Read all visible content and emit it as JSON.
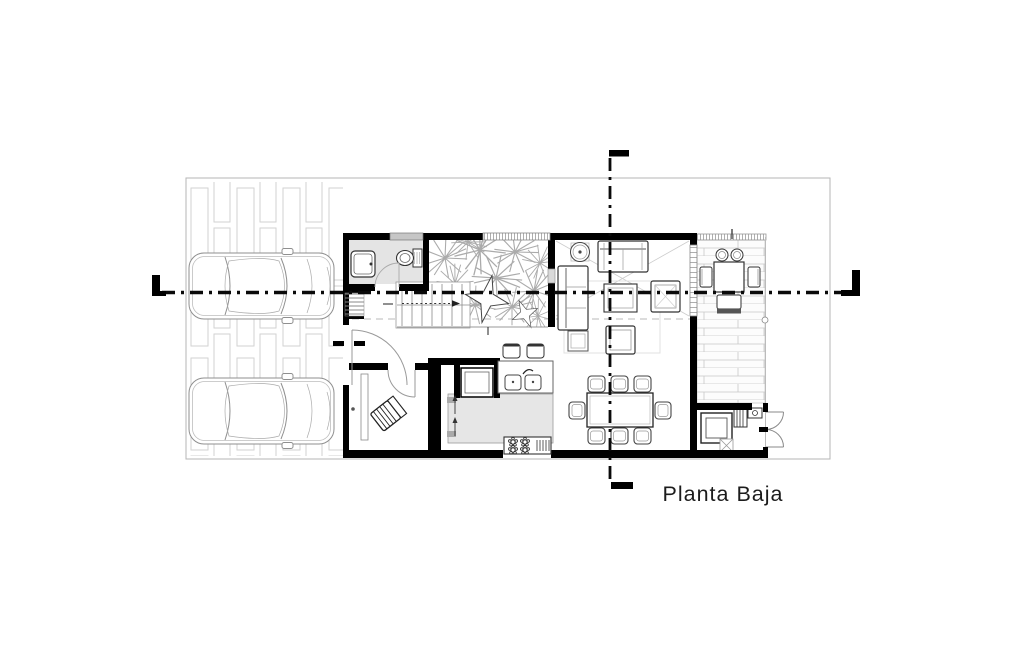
{
  "title": {
    "label": "Planta Baja"
  },
  "colors": {
    "walls": "#000000",
    "paper": "#ffffff",
    "floor_tint": "#e4e4e4",
    "island_tint": "#e6e6e6",
    "linework": "#8a8a8a",
    "light_line": "#c9c9c9",
    "boundary": "#b5b5b5",
    "text": "#1c1c1c"
  },
  "legend": {
    "fixtures": [
      "car",
      "sink",
      "toilet",
      "staircase",
      "courtyard-planting",
      "sofa",
      "coffee-table",
      "armchair",
      "side-table",
      "dining-table",
      "dining-chair",
      "kitchen-island",
      "refrigerator",
      "stove",
      "kitchen-sink",
      "bar-stool",
      "outdoor-table",
      "outdoor-chair",
      "washer",
      "floor-drain",
      "double-door",
      "entry-door",
      "section-cut-line",
      "deck-paving",
      "driveway-paving"
    ]
  }
}
